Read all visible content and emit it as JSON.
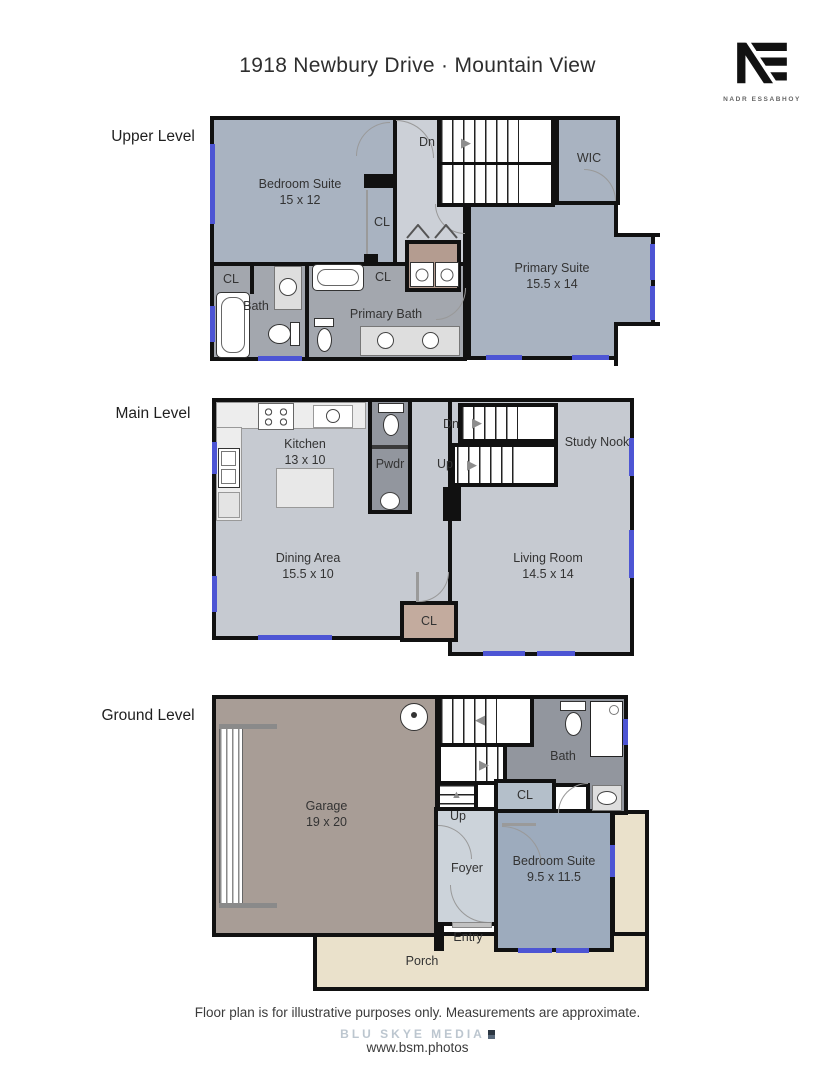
{
  "header": {
    "title": "1918 Newbury Drive · Mountain View",
    "logo_monogram": "NE",
    "logo_name": "NADR ESSABHOY"
  },
  "upper": {
    "level_label": "Upper Level",
    "bedroom_suite_name": "Bedroom Suite",
    "bedroom_suite_dims": "15 x 12",
    "dn": "Dn",
    "wic": "WIC",
    "cl_bedroom_closet": "CL",
    "cl_bath_closet": "CL",
    "cl_linen_closet": "CL",
    "bath": "Bath",
    "primary_bath": "Primary Bath",
    "primary_suite_name": "Primary Suite",
    "primary_suite_dims": "15.5 x 14"
  },
  "main": {
    "level_label": "Main Level",
    "kitchen_name": "Kitchen",
    "kitchen_dims": "13 x 10",
    "pwdr": "Pwdr",
    "dn": "Dn",
    "up": "Up",
    "study_nook": "Study Nook",
    "dining_name": "Dining Area",
    "dining_dims": "15.5 x 10",
    "living_name": "Living Room",
    "living_dims": "14.5 x 14",
    "cl": "CL"
  },
  "ground": {
    "level_label": "Ground Level",
    "garage_name": "Garage",
    "garage_dims": "19 x 20",
    "up": "Up",
    "bath": "Bath",
    "cl": "CL",
    "foyer": "Foyer",
    "entry": "Entry",
    "bedroom_suite_name": "Bedroom Suite",
    "bedroom_suite_dims": "9.5 x 11.5",
    "porch": "Porch"
  },
  "footer": {
    "disclaimer": "Floor plan is for illustrative purposes only. Measurements are approximate.",
    "brand": "BLU SKYE MEDIA",
    "url": "www.bsm.photos"
  },
  "icons": {
    "arrow_right": "▶",
    "arrow_left": "◀",
    "arrow_up": "▲"
  },
  "colors": {
    "room_blue": "#a9b3c1",
    "floor_light": "#c6cad1",
    "hall_light": "#ccd0d7",
    "bath_gray": "#a3a7ae",
    "dark_gray": "#92969e",
    "laundry_brown": "#b49c90",
    "closet_tan": "#c3ab9e",
    "garage_taupe": "#a89d96",
    "porch_beige": "#eae1cb",
    "ground_bedroom_blue": "#9dabbd",
    "ground_closet_blue": "#b4bfca",
    "foyer_light": "#ccd3da",
    "window_blue": "#4d55d4",
    "wall_black": "#111111"
  }
}
